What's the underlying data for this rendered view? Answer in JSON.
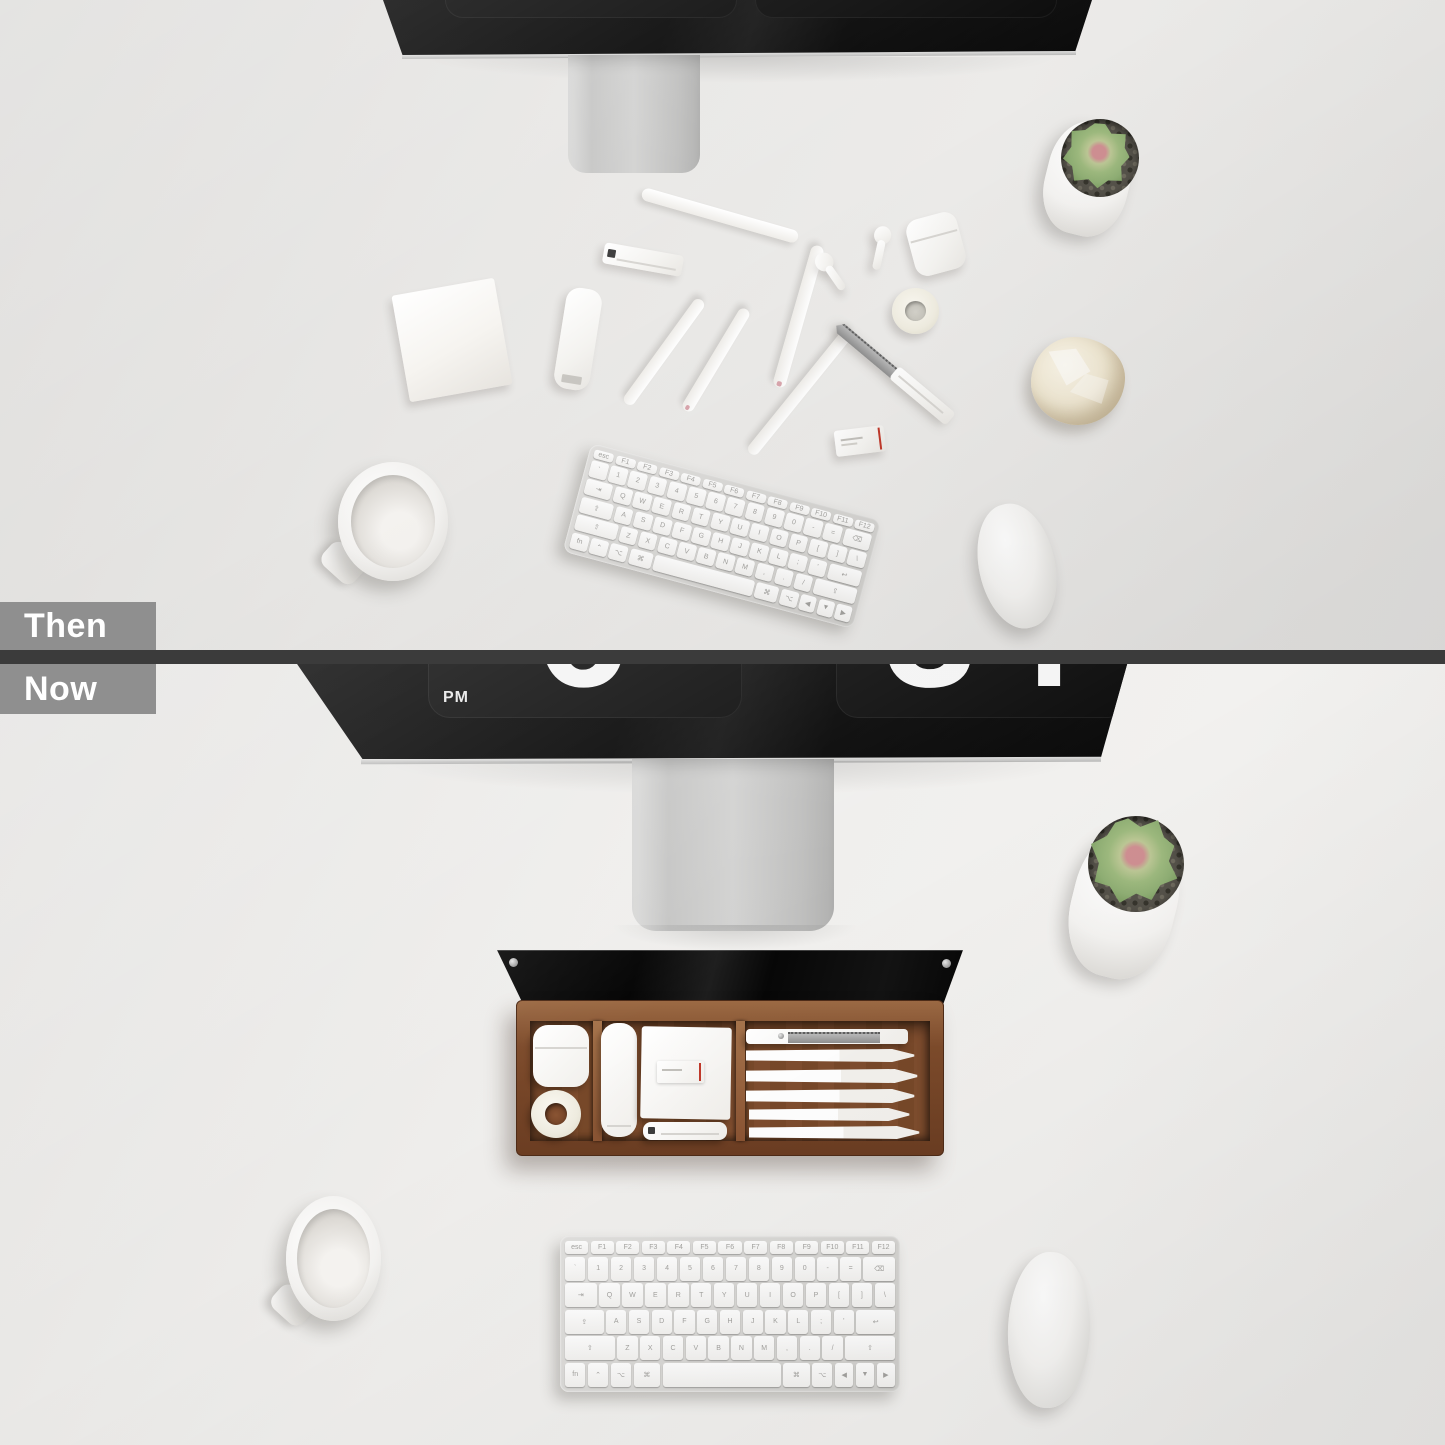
{
  "labels": {
    "then": "Then",
    "now": "Now"
  },
  "clock": {
    "meridiem": "PM",
    "hour": "6",
    "minutes": "34"
  },
  "keyboard": {
    "rows": [
      [
        "esc",
        "F1",
        "F2",
        "F3",
        "F4",
        "F5",
        "F6",
        "F7",
        "F8",
        "F9",
        "F10",
        "F11",
        "F12"
      ],
      [
        "`",
        "1",
        "2",
        "3",
        "4",
        "5",
        "6",
        "7",
        "8",
        "9",
        "0",
        "-",
        "=",
        "⌫"
      ],
      [
        "⇥",
        "Q",
        "W",
        "E",
        "R",
        "T",
        "Y",
        "U",
        "I",
        "O",
        "P",
        "[",
        "]",
        "\\"
      ],
      [
        "⇪",
        "A",
        "S",
        "D",
        "F",
        "G",
        "H",
        "J",
        "K",
        "L",
        ";",
        "'",
        "↩"
      ],
      [
        "⇧",
        "Z",
        "X",
        "C",
        "V",
        "B",
        "N",
        "M",
        ",",
        ".",
        "/",
        "⇧"
      ],
      [
        "fn",
        "⌃",
        "⌥",
        "⌘",
        "",
        "⌘",
        "⌥",
        "◀",
        "▼",
        "▶"
      ]
    ]
  },
  "scene": {
    "then_items": [
      "monitor",
      "monitor-stand",
      "succulent-plant",
      "sticky-notes",
      "stapler",
      "pen-tube",
      "white-pens",
      "airpods-earbuds",
      "airpods-case",
      "washi-tape-roll",
      "utility-knife",
      "eraser-box",
      "crumpled-paper",
      "coffee-mug",
      "magic-keyboard",
      "magic-mouse"
    ],
    "now_items": [
      "monitor-flip-clock",
      "monitor-stand",
      "succulent-plant",
      "glass-lid",
      "walnut-organizer-tray",
      "airpods-case",
      "washi-tape-roll",
      "pen-tube",
      "notepad",
      "eraser-box",
      "stapler",
      "utility-knife",
      "white-pens",
      "coffee-mug",
      "magic-keyboard",
      "magic-mouse"
    ]
  },
  "colors": {
    "desk_then": "#e6e5e3",
    "desk_now": "#f0efed",
    "divider": "#3b3b3b",
    "label_bg": "#8f8f8f",
    "label_text": "#ffffff",
    "screen_black": "#070707",
    "aluminum": "#c9c8c6",
    "wood_rim": "#8a5636",
    "wood_floor": "#7c4c2d",
    "glass": "#0c0c0c",
    "succulent_green": "#8fae74",
    "succulent_pink": "#cf8f92",
    "pebbles": "#55524a",
    "paper_cream": "#efe7d2",
    "accent_red": "#c0392b",
    "digit_white": "#f4f4f4"
  }
}
